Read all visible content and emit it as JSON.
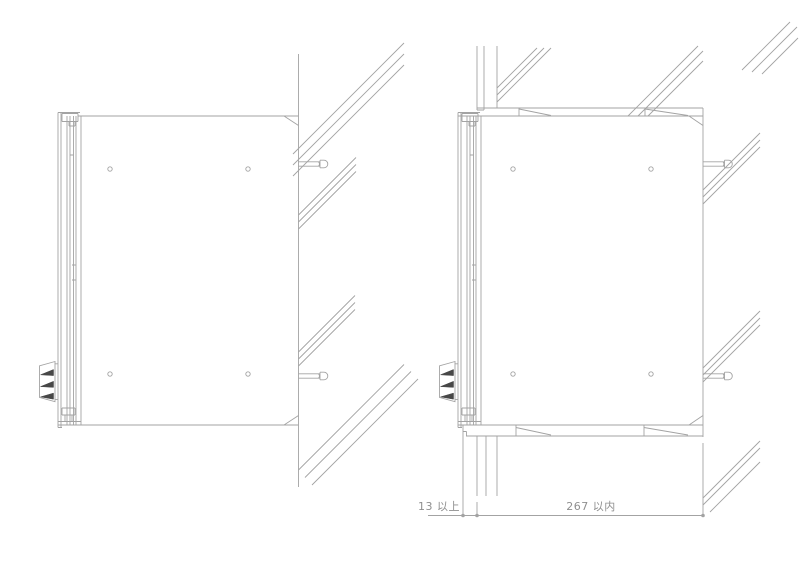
{
  "dimensions": {
    "front_clearance_label": "13 以上",
    "recess_width_label": "267 以内"
  },
  "style": {
    "line_color": "#a3a3a3",
    "dark_accent_color": "#474747",
    "text_color": "#8f8f8f",
    "background_color": "#ffffff"
  }
}
